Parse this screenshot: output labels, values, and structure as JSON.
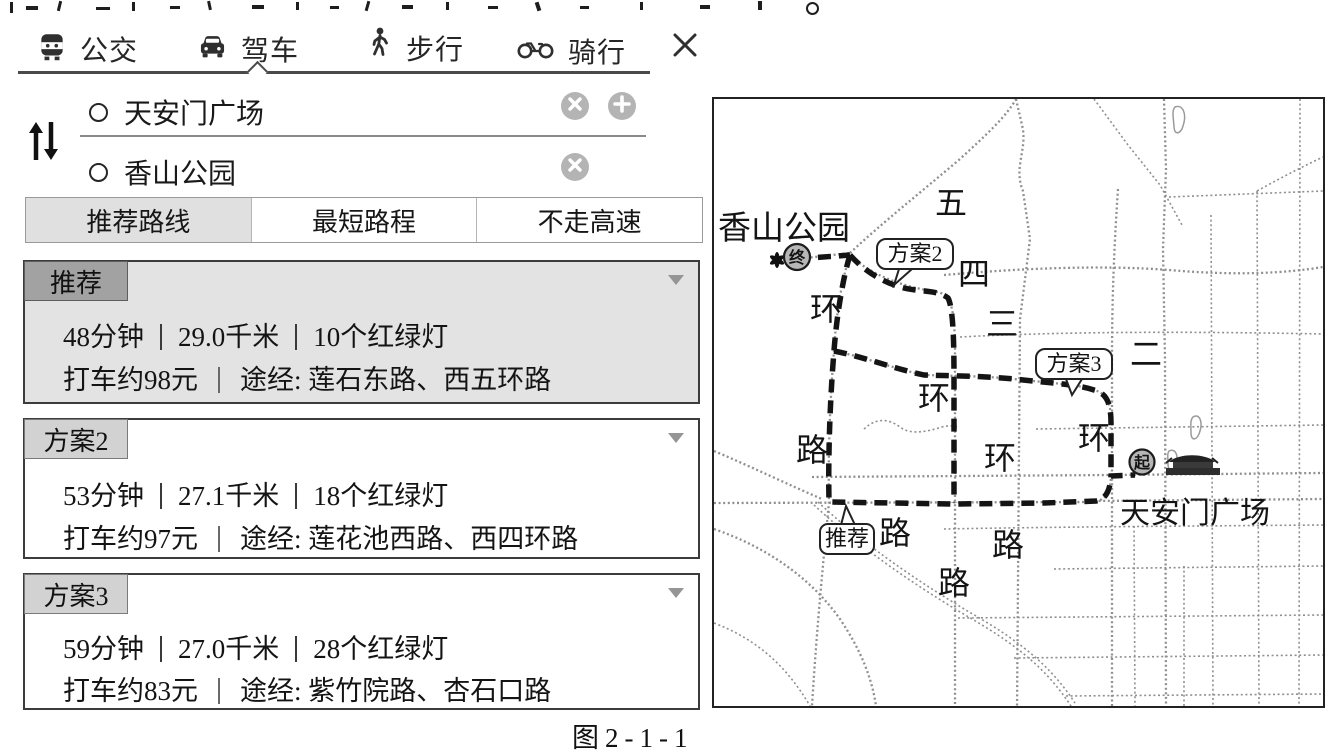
{
  "colors": {
    "panel_text": "#1c1c1c",
    "icon_gray": "#b4b4b4",
    "selected_tab_bg": "#e0e0e0",
    "highlight_card_bg": "#e3e3e3",
    "badge_dark_bg": "#a2a2a2",
    "badge_light_bg": "#d2d2d2",
    "route_line": "#141414",
    "road_line": "#8f8f8f"
  },
  "tabbar": {
    "tabs": [
      {
        "label": "公交",
        "icon": "bus-icon",
        "active": false
      },
      {
        "label": "驾车",
        "icon": "car-icon",
        "active": true
      },
      {
        "label": "步行",
        "icon": "pedestrian-icon",
        "active": false
      },
      {
        "label": "骑行",
        "icon": "bicycle-icon",
        "active": false
      }
    ]
  },
  "route_form": {
    "origin": "天安门广场",
    "destination": "香山公园"
  },
  "route_type_tabs": [
    {
      "label": "推荐路线",
      "selected": true
    },
    {
      "label": "最短路程",
      "selected": false
    },
    {
      "label": "不走高速",
      "selected": false
    }
  ],
  "routes": [
    {
      "badge": "推荐",
      "duration": "48分钟",
      "distance": "29.0千米",
      "traffic_lights": "10个红绿灯",
      "taxi_fare": "打车约98元",
      "via": "途经: 莲石东路、西五环路",
      "highlighted": true
    },
    {
      "badge": "方案2",
      "duration": "53分钟",
      "distance": "27.1千米",
      "traffic_lights": "18个红绿灯",
      "taxi_fare": "打车约97元",
      "via": "途经: 莲花池西路、西四环路",
      "highlighted": false
    },
    {
      "badge": "方案3",
      "duration": "59分钟",
      "distance": "27.0千米",
      "traffic_lights": "28个红绿灯",
      "taxi_fare": "打车约83元",
      "via": "途经: 紫竹院路、杏石口路",
      "highlighted": false
    }
  ],
  "map": {
    "destination_label": "香山公园",
    "origin_label": "天安门广场",
    "destination_marker": "终",
    "origin_marker": "起",
    "balloons": {
      "recommended": "推荐",
      "plan2": "方案2",
      "plan3": "方案3"
    },
    "rings": {
      "ring5": [
        "五",
        "环",
        "路"
      ],
      "ring4": [
        "四",
        "环",
        "路"
      ],
      "ring3": [
        "三",
        "环",
        "路"
      ],
      "ring2": [
        "二",
        "环",
        "路"
      ]
    }
  },
  "caption": "图2-1-1"
}
